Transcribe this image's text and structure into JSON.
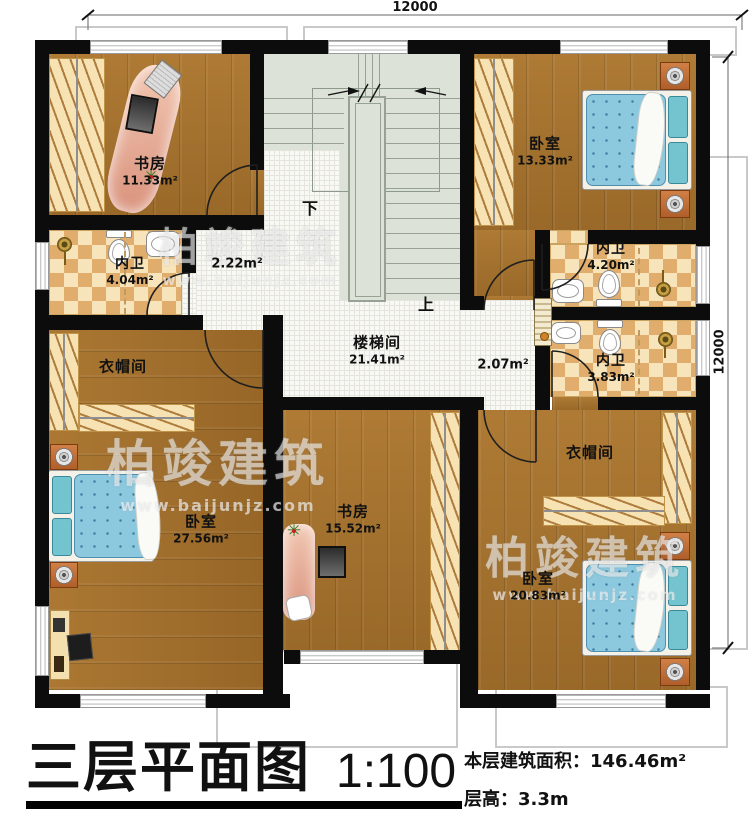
{
  "dimensions": {
    "top": "12000",
    "right": "12000"
  },
  "stairs": {
    "down": "下",
    "up": "上"
  },
  "rooms": {
    "study_tl": {
      "name": "书房",
      "area": "11.33m²"
    },
    "bedroom_tr": {
      "name": "卧室",
      "area": "13.33m²"
    },
    "bath_tr": {
      "name": "内卫",
      "area": "4.20m²"
    },
    "bath_l": {
      "name": "内卫",
      "area": "4.04m²"
    },
    "hall_l": {
      "area": "2.22m²"
    },
    "stairwell": {
      "name": "楼梯间",
      "area": "21.41m²"
    },
    "hall_r": {
      "area": "2.07m²"
    },
    "bath_r": {
      "name": "内卫",
      "area": "3.83m²"
    },
    "cloak_l": {
      "name": "衣帽间"
    },
    "cloak_r": {
      "name": "衣帽间"
    },
    "bedroom_bl": {
      "name": "卧室",
      "area": "27.56m²"
    },
    "study_bm": {
      "name": "书房",
      "area": "15.52m²"
    },
    "bedroom_br": {
      "name": "卧室",
      "area": "20.83m²"
    }
  },
  "watermark": {
    "brand": "柏竣建筑",
    "site": "www.baijunjz.com"
  },
  "title_block": {
    "title": "三层平面图",
    "scale": "1:100",
    "area": "本层建筑面积：146.46m²",
    "floor_height": "层高：3.3m"
  },
  "colors": {
    "wall": "#0c0c0c",
    "wood": "#a5712c",
    "tile": "#f8f8f4",
    "checker_dark": "#e1ad6c",
    "checker_light": "#f8e4ba",
    "stair": "#dce2d7",
    "bed": "#8cc8de",
    "desk": "#d88f79"
  }
}
